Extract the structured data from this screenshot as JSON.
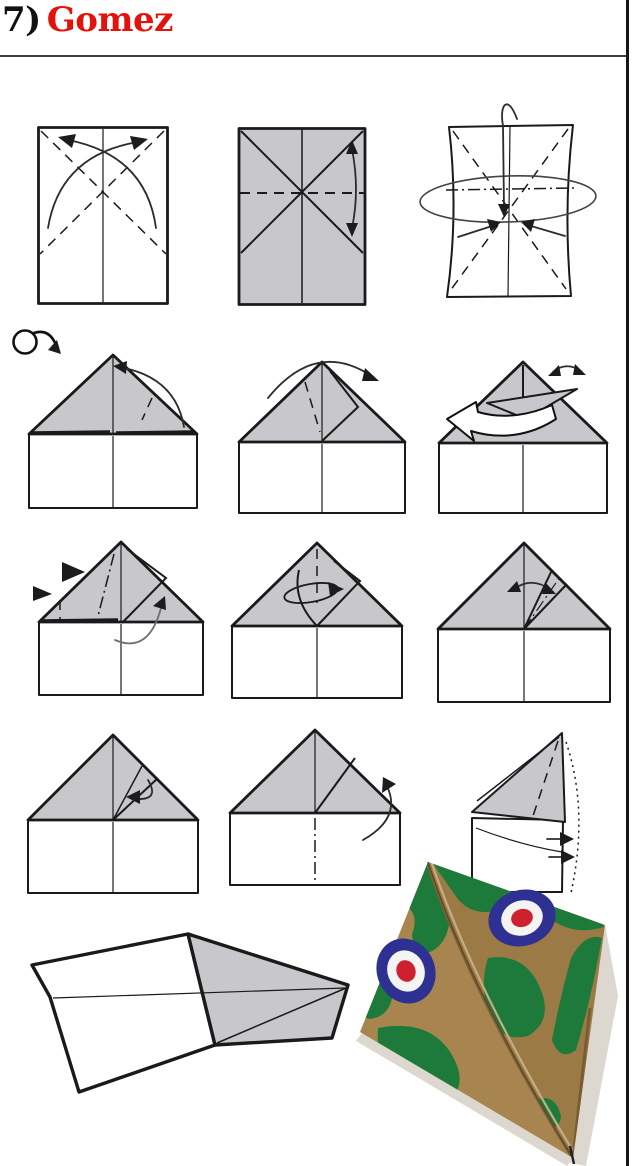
{
  "header": {
    "title_number": "7)",
    "title_name": "Gomez"
  },
  "colors": {
    "title_red": "#e3120b",
    "rule_color": "#3f3f3f",
    "outline": "#1a1a1a",
    "paper_grey": "#c7c7cc",
    "camo_tan": "#a8854f",
    "camo_tan_dark": "#9c7a45",
    "camo_green": "#1d7a3b",
    "roundel_blue": "#2e3192",
    "roundel_white": "#f4f4f2",
    "roundel_red": "#cf2030",
    "shadow": "#ddd8cf"
  },
  "figures": [
    {
      "step": 1,
      "icon": "rectangle-with-diagonal-crease-arrows-icon"
    },
    {
      "step": 2,
      "icon": "creased-sheet-fold-in-half-icon"
    },
    {
      "step": 3,
      "icon": "collapse-sides-inward-icon"
    },
    {
      "step": 4,
      "icon": "turn-over-icon"
    },
    {
      "step": 5,
      "icon": "house-fold-corner-to-apex-icon"
    },
    {
      "step": 6,
      "icon": "house-fold-flap-over-right-icon"
    },
    {
      "step": 7,
      "icon": "house-unfold-flap-left-icon"
    },
    {
      "step": 8,
      "icon": "house-inside-reverse-fold-icon"
    },
    {
      "step": 9,
      "icon": "house-wrap-flap-around-icon"
    },
    {
      "step": 10,
      "icon": "house-narrow-flap-swing-icon"
    },
    {
      "step": 11,
      "icon": "house-tuck-flap-icon"
    },
    {
      "step": 12,
      "icon": "fold-model-in-half-icon"
    },
    {
      "step": 13,
      "icon": "fold-wings-down-icon"
    },
    {
      "step": 14,
      "icon": "finished-plane-outline-icon"
    },
    {
      "step": 15,
      "icon": "finished-plane-camouflage-icon"
    }
  ]
}
